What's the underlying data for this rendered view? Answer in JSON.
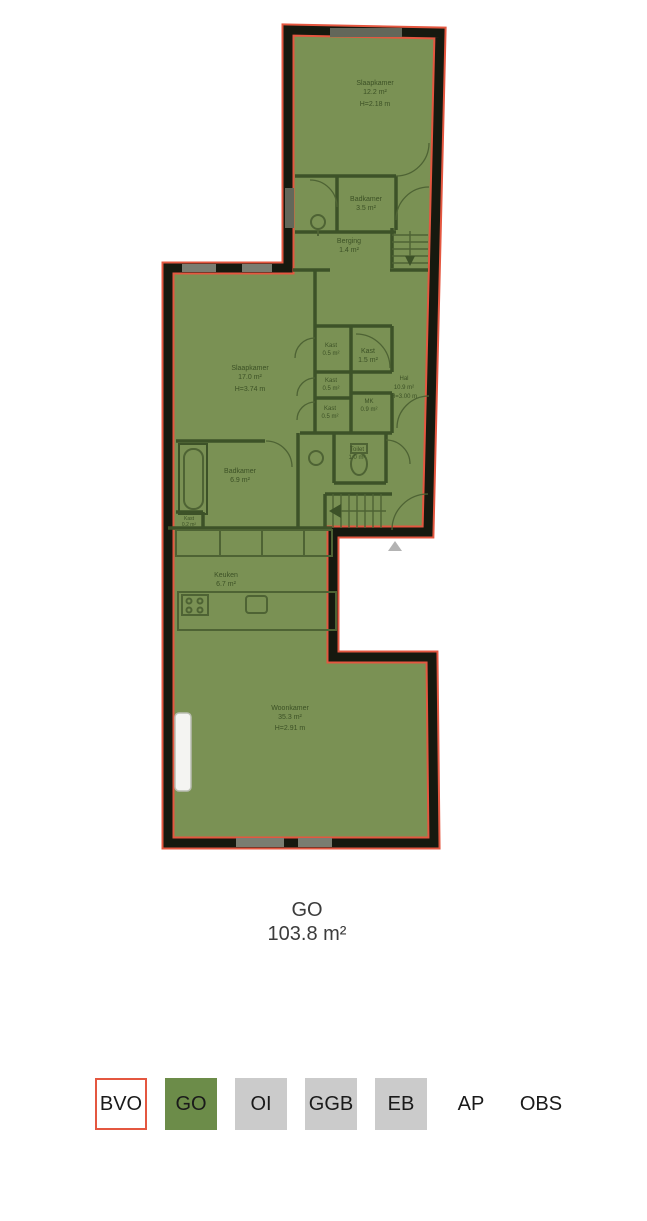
{
  "plan": {
    "summary": {
      "label": "GO",
      "area": "103.8 m²"
    },
    "rooms": [
      {
        "name": "Slaapkamer",
        "area": "12.2 m²",
        "height": "H=2.18 m"
      },
      {
        "name": "Badkamer",
        "area": "3.5 m²"
      },
      {
        "name": "Berging",
        "area": "1.4 m²"
      },
      {
        "name": "Slaapkamer",
        "area": "17.0 m²",
        "height": "H=3.74 m"
      },
      {
        "name": "Kast",
        "area": "0.5 m²"
      },
      {
        "name": "Kast",
        "area": "1.5 m²"
      },
      {
        "name": "Kast",
        "area": "0.5 m²"
      },
      {
        "name": "MK",
        "area": "0.9 m²"
      },
      {
        "name": "Kast",
        "area": "0.5 m²"
      },
      {
        "name": "Hal",
        "area": "10.9 m²",
        "height": "H=3.00 m"
      },
      {
        "name": "Toilet",
        "area": "1.0 m²"
      },
      {
        "name": "Badkamer",
        "area": "6.9 m²"
      },
      {
        "name": "Kast",
        "area": "0.2 m²"
      },
      {
        "name": "Keuken",
        "area": "6.7 m²"
      },
      {
        "name": "Woonkamer",
        "area": "35.3 m²",
        "height": "H=2.91 m"
      }
    ]
  },
  "legend": {
    "items": [
      {
        "label": "BVO",
        "style": "outline",
        "selected": false
      },
      {
        "label": "GO",
        "style": "green",
        "selected": true
      },
      {
        "label": "OI",
        "style": "gray",
        "selected": false
      },
      {
        "label": "GGB",
        "style": "gray",
        "selected": false
      },
      {
        "label": "EB",
        "style": "gray",
        "selected": false
      },
      {
        "label": "AP",
        "style": "plain",
        "selected": false
      },
      {
        "label": "OBS",
        "style": "plain",
        "selected": false
      }
    ]
  },
  "colors": {
    "accent_red": "#e45740",
    "go_green": "#6c8c49",
    "plan_green": "#7a9154",
    "legend_gray": "#cbcbcb",
    "wall_black": "#16190f"
  }
}
